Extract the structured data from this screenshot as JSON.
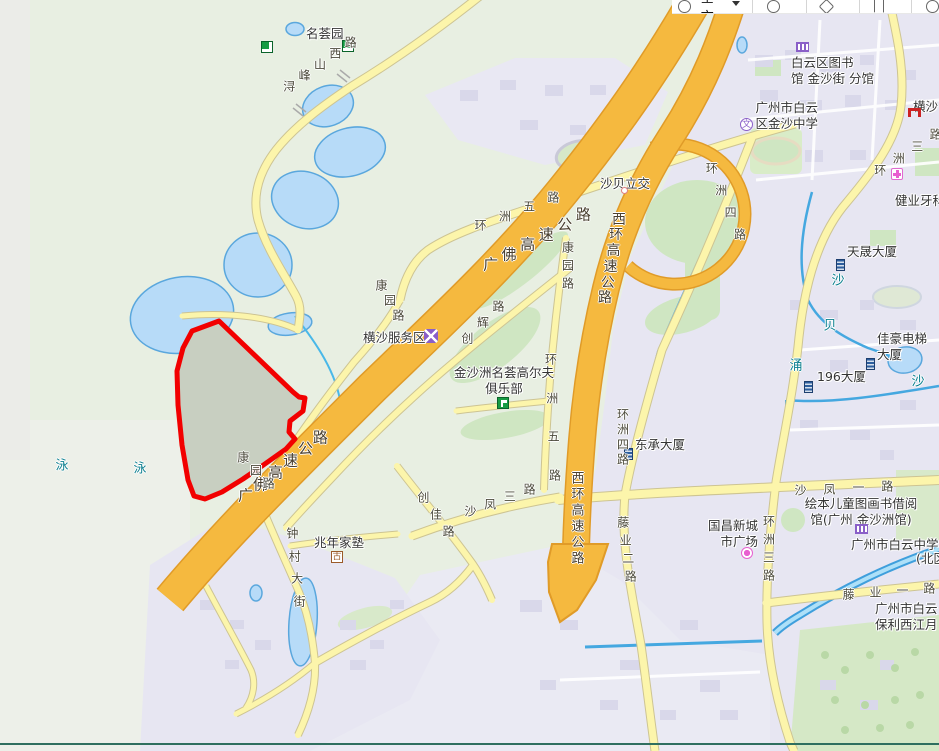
{
  "toolbar": {
    "city_label": "全市"
  },
  "map": {
    "highlight": {
      "name": "selected-area",
      "color": "#f20000",
      "points": "219,321 293,392 299,397 305,398 303,411 290,421 289,432 295,439 286,449 262,466 243,479 222,492 205,499 194,496 188,480 182,445 178,405 177,371 183,348 192,331"
    },
    "poi_labels": [
      {
        "name": "minghuiyuan-label",
        "lines": [
          "名荟园"
        ],
        "x": 306,
        "y": 26
      },
      {
        "name": "baiyun-library-branch-label",
        "lines": [
          "白云区图书",
          "馆 金沙街 分馆"
        ],
        "x": 791,
        "y": 55
      },
      {
        "name": "jinsha-middle-school-label",
        "lines": [
          "广州市白云",
          "区金沙中学"
        ],
        "x": 742,
        "y": 100,
        "w": 76,
        "align": "right"
      },
      {
        "name": "hengsha-label",
        "lines": [
          "横沙"
        ],
        "x": 913,
        "y": 99
      },
      {
        "name": "jianye-dental-label",
        "lines": [
          "健业牙科"
        ],
        "x": 895,
        "y": 193
      },
      {
        "name": "tiansheng-building-label",
        "lines": [
          "天晟大厦"
        ],
        "x": 847,
        "y": 244
      },
      {
        "name": "jiahao-elevator-building-label",
        "lines": [
          "佳豪电梯",
          "大厦"
        ],
        "x": 877,
        "y": 331
      },
      {
        "name": "building-196-label",
        "lines": [
          "196大厦"
        ],
        "x": 817,
        "y": 369
      },
      {
        "name": "dongcheng-building-label",
        "lines": [
          "东承大厦"
        ],
        "x": 635,
        "y": 437
      },
      {
        "name": "golf-club-label",
        "lines": [
          "金沙洲名荟高尔夫",
          "俱乐部"
        ],
        "x": 450,
        "y": 365,
        "w": 108,
        "align": "center"
      },
      {
        "name": "hengsha-service-area-label",
        "lines": [
          "横沙服务区"
        ],
        "x": 363,
        "y": 330
      },
      {
        "name": "shabei-interchange-label",
        "lines": [
          "沙贝立交"
        ],
        "x": 600,
        "y": 176
      },
      {
        "name": "zhaonian-school-label",
        "lines": [
          "兆年家塾"
        ],
        "x": 314,
        "y": 535
      },
      {
        "name": "guochang-plaza-label",
        "lines": [
          "国昌新城",
          "市广场"
        ],
        "x": 700,
        "y": 518,
        "w": 58,
        "align": "right"
      },
      {
        "name": "picture-book-library-label",
        "lines": [
          "绘本儿童图画书借阅",
          "馆(广州 金沙洲馆)"
        ],
        "x": 793,
        "y": 496,
        "w": 136,
        "align": "center"
      },
      {
        "name": "baiyun-middle-school-label",
        "lines": [
          "广州市白云中学"
        ],
        "x": 851,
        "y": 537
      },
      {
        "name": "baiyun-middle-school-north-label",
        "lines": [
          "(北区"
        ],
        "x": 916,
        "y": 551
      },
      {
        "name": "baoli-xijiangyue-label",
        "lines": [
          "广州市白云",
          "保利西江月"
        ],
        "x": 875,
        "y": 601
      }
    ],
    "icons": [
      {
        "type": "park",
        "name": "park-icon",
        "x": 342,
        "y": 40
      },
      {
        "type": "park",
        "name": "park-icon-small",
        "x": 261,
        "y": 41
      },
      {
        "type": "library",
        "name": "library-icon",
        "x": 796,
        "y": 42
      },
      {
        "type": "school",
        "name": "school-icon",
        "x": 740,
        "y": 118,
        "glyph": "文"
      },
      {
        "type": "arch",
        "name": "archway-icon",
        "x": 908,
        "y": 108
      },
      {
        "type": "clinic",
        "name": "clinic-icon",
        "x": 891,
        "y": 168
      },
      {
        "type": "building",
        "name": "building-icon-tiansheng",
        "x": 836,
        "y": 259
      },
      {
        "type": "building",
        "name": "building-icon-jiahao",
        "x": 866,
        "y": 358
      },
      {
        "type": "building",
        "name": "building-icon-196",
        "x": 804,
        "y": 381
      },
      {
        "type": "building",
        "name": "building-icon-dongcheng",
        "x": 624,
        "y": 448
      },
      {
        "type": "golf",
        "name": "golf-icon",
        "x": 497,
        "y": 397
      },
      {
        "type": "service",
        "name": "service-area-icon",
        "x": 424,
        "y": 329
      },
      {
        "type": "dot",
        "name": "interchange-dot-icon",
        "x": 621,
        "y": 187
      },
      {
        "type": "historic",
        "name": "historic-site-icon",
        "x": 331,
        "y": 551,
        "glyph": "古"
      },
      {
        "type": "shopping",
        "name": "shopping-icon",
        "x": 741,
        "y": 547
      },
      {
        "type": "library",
        "name": "library-icon-2",
        "x": 855,
        "y": 524
      }
    ],
    "road_labels": [
      {
        "name": "xunfengshan-west-road-label",
        "text": "浔峰山西路",
        "x": 320,
        "y": 64,
        "angle": -36,
        "step": 19
      },
      {
        "name": "huanzhou-5-road-label",
        "text": "环洲五路",
        "x": 517,
        "y": 211,
        "angle": -21,
        "step": 26
      },
      {
        "name": "guangfo-expressway-label",
        "text": "广佛高速公路",
        "x": 537,
        "y": 239,
        "angle": -28,
        "step": 21,
        "size": 15,
        "color": "#4a4030"
      },
      {
        "name": "guangfo-expressway-label-2",
        "text": "广佛高速公路",
        "x": 283,
        "y": 466,
        "angle": -38,
        "step": 19,
        "size": 15,
        "color": "#4a4030"
      },
      {
        "name": "xihuan-expressway-label",
        "text": "西环高速公路",
        "x": 612,
        "y": 258,
        "angle": 100,
        "step": 16,
        "size": 14,
        "color": "#4a4030"
      },
      {
        "name": "xihuan-expressway-label-2",
        "text": "西环高速公路",
        "x": 578,
        "y": 517,
        "angle": 90,
        "step": 16,
        "size": 13,
        "color": "#4a4030"
      },
      {
        "name": "huanzhou-4-road-label",
        "text": "环洲四路",
        "x": 726,
        "y": 201,
        "angle": 67,
        "step": 24
      },
      {
        "name": "huanzhou-4-road-label-2",
        "text": "环洲四路",
        "x": 623,
        "y": 436,
        "angle": 90,
        "step": 15
      },
      {
        "name": "huanzhou-5-road-label-2",
        "text": "环洲五路",
        "x": 553,
        "y": 417,
        "angle": 88,
        "step": 39
      },
      {
        "name": "kangyuan-road-label",
        "text": "康园路",
        "x": 390,
        "y": 300,
        "angle": 60,
        "step": 17
      },
      {
        "name": "kangyuan-road-label-2",
        "text": "康园路",
        "x": 568,
        "y": 265,
        "angle": 90,
        "step": 18
      },
      {
        "name": "kangyuan-road-label-3",
        "text": "康园路",
        "x": 256,
        "y": 470,
        "angle": 45,
        "step": 18
      },
      {
        "name": "chuanghui-road-label",
        "text": "创辉路",
        "x": 483,
        "y": 322,
        "angle": -45,
        "step": 22
      },
      {
        "name": "chuangjia-road-label",
        "text": "创佳路",
        "x": 436,
        "y": 514,
        "angle": 53,
        "step": 21
      },
      {
        "name": "shafeng-3-road-label",
        "text": "沙凤三路",
        "x": 500,
        "y": 500,
        "angle": -20,
        "step": 21
      },
      {
        "name": "shafeng-1-road-label",
        "text": "沙凤一路",
        "x": 844,
        "y": 488,
        "angle": -3,
        "step": 29
      },
      {
        "name": "tengye-1-road-label",
        "text": "藤业一路",
        "x": 889,
        "y": 591,
        "angle": -4,
        "step": 27
      },
      {
        "name": "tengye-2-road-label",
        "text": "藤业二路",
        "x": 627,
        "y": 549,
        "angle": 82,
        "step": 18
      },
      {
        "name": "huanzhou-3-road-label",
        "text": "环洲三路",
        "x": 908,
        "y": 152,
        "angle": -33,
        "step": 22
      },
      {
        "name": "huanzhou-3-road-label-2",
        "text": "环洲三路",
        "x": 769,
        "y": 548,
        "angle": 90,
        "step": 18
      },
      {
        "name": "zhongcun-street-label",
        "text": "钟村大街",
        "x": 296,
        "y": 567,
        "angle": 84,
        "step": 23
      }
    ],
    "water_labels": [
      {
        "name": "water-char-yong-1",
        "text": "泳",
        "x": 62,
        "y": 464
      },
      {
        "name": "water-char-yong-2",
        "text": "泳",
        "x": 140,
        "y": 467
      },
      {
        "name": "water-char-sha-1",
        "text": "沙",
        "x": 838,
        "y": 279
      },
      {
        "name": "water-char-bei",
        "text": "贝",
        "x": 830,
        "y": 324
      },
      {
        "name": "water-char-chong",
        "text": "涌",
        "x": 796,
        "y": 364
      },
      {
        "name": "water-char-sha-2",
        "text": "沙",
        "x": 918,
        "y": 380
      }
    ]
  }
}
